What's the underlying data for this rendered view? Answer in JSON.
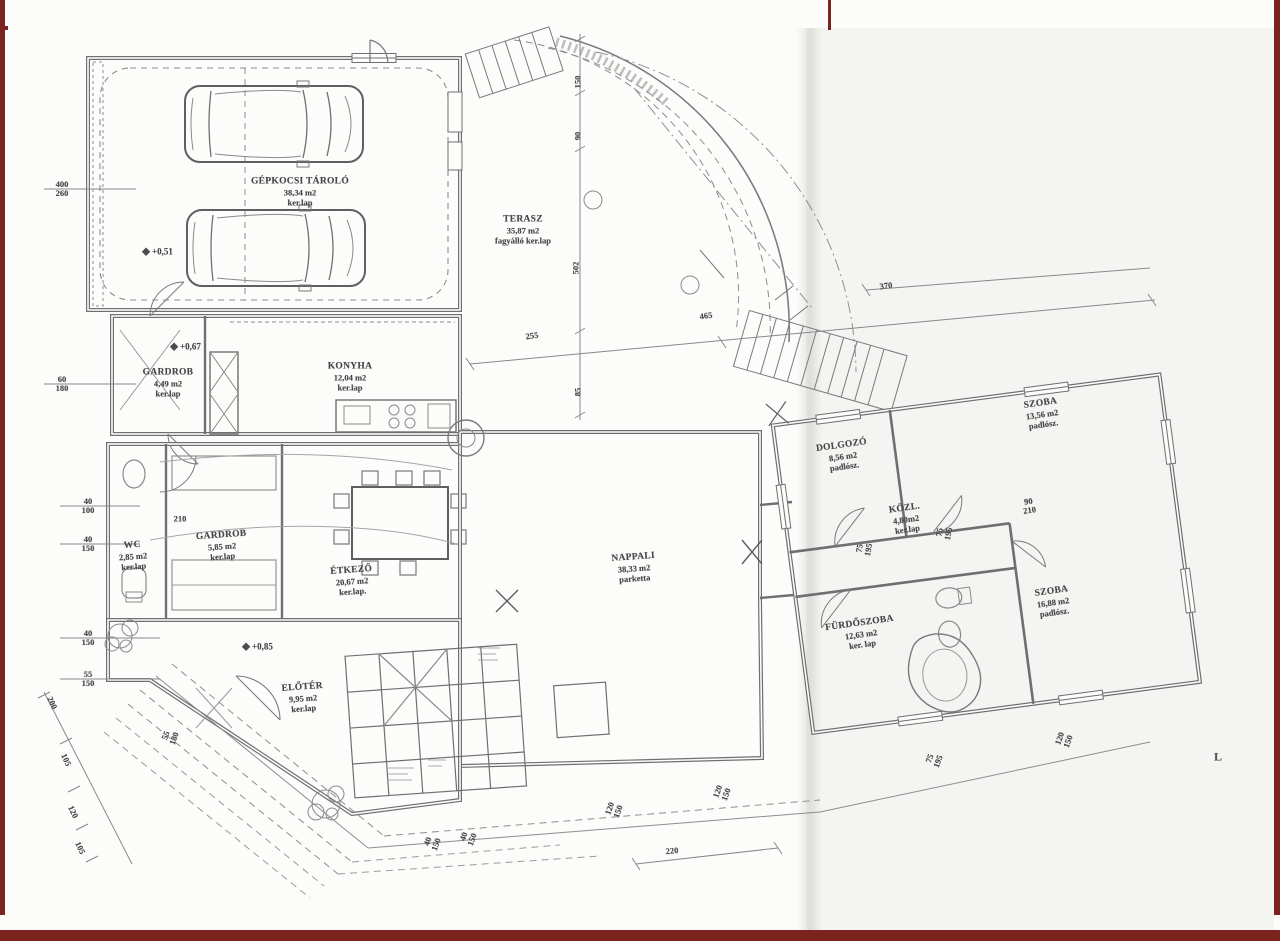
{
  "palette": {
    "frame": "#7c2320",
    "wall": "#6f6f6f",
    "light_line": "#9a9a9a",
    "text": "#474747"
  },
  "plan_title": "Hungarian family house ground-floor plan (scanned blueprint)",
  "rooms": [
    {
      "id": "gepkocsi-tarolo",
      "name": "GÉPKOCSI TÁROLÓ",
      "area": "38,34 m2",
      "floor": "ker.lap",
      "x": 300,
      "y": 192,
      "rot": 0
    },
    {
      "id": "terasz",
      "name": "TERASZ",
      "area": "35,87 m2",
      "floor": "fagyálló ker.lap",
      "x": 523,
      "y": 230,
      "rot": 0
    },
    {
      "id": "konyha",
      "name": "KONYHA",
      "area": "12,04 m2",
      "floor": "ker.lap",
      "x": 350,
      "y": 377,
      "rot": 0
    },
    {
      "id": "gardrob-1",
      "name": "GARDROB",
      "area": "4,49 m2",
      "floor": "ker.lap",
      "x": 168,
      "y": 383,
      "rot": 0
    },
    {
      "id": "wc",
      "name": "WC",
      "area": "2,85 m2",
      "floor": "ker.lap",
      "x": 133,
      "y": 556,
      "rot": -4
    },
    {
      "id": "gardrob-2",
      "name": "GARDROB",
      "area": "5,85 m2",
      "floor": "ker.lap",
      "x": 222,
      "y": 546,
      "rot": -4
    },
    {
      "id": "etkezo",
      "name": "ÉTKEZŐ",
      "area": "20,67 m2",
      "floor": "ker.lap.",
      "x": 352,
      "y": 581,
      "rot": -4
    },
    {
      "id": "nappali",
      "name": "NAPPALI",
      "area": "38,33 m2",
      "floor": "parketta",
      "x": 634,
      "y": 568,
      "rot": -4
    },
    {
      "id": "eloter",
      "name": "ELŐTÉR",
      "area": "9,95 m2",
      "floor": "ker.lap",
      "x": 303,
      "y": 698,
      "rot": -4
    },
    {
      "id": "dolgozo",
      "name": "DOLGOZÓ",
      "area": "8,56 m2",
      "floor": "padlósz.",
      "x": 843,
      "y": 456,
      "rot": -8
    },
    {
      "id": "szoba-1",
      "name": "SZOBA",
      "area": "13,56 m2",
      "floor": "padlósz.",
      "x": 1042,
      "y": 414,
      "rot": -8
    },
    {
      "id": "kozl",
      "name": "KÖZL.",
      "area": "4,80m2",
      "floor": "ker.lap",
      "x": 906,
      "y": 519,
      "rot": -8
    },
    {
      "id": "furdoszoba",
      "name": "FÜRDŐSZOBA",
      "area": "12,63 m2",
      "floor": "ker. lap",
      "x": 861,
      "y": 634,
      "rot": -8
    },
    {
      "id": "szoba-2",
      "name": "SZOBA",
      "area": "16,88 m2",
      "floor": "padlósz.",
      "x": 1053,
      "y": 602,
      "rot": -8
    }
  ],
  "level_markers": [
    {
      "label": "+0,51",
      "x": 158,
      "y": 252
    },
    {
      "label": "+0,67",
      "x": 186,
      "y": 347
    },
    {
      "label": "+0,85",
      "x": 258,
      "y": 647
    }
  ],
  "dimensions": [
    {
      "t": "400",
      "b": "260",
      "x": 62,
      "y": 189,
      "rot": 0
    },
    {
      "t": "60",
      "b": "180",
      "x": 62,
      "y": 384,
      "rot": 0
    },
    {
      "t": "40",
      "b": "100",
      "x": 88,
      "y": 506,
      "rot": 0
    },
    {
      "t": "40",
      "b": "150",
      "x": 88,
      "y": 544,
      "rot": 0
    },
    {
      "t": "40",
      "b": "150",
      "x": 88,
      "y": 638,
      "rot": 0
    },
    {
      "t": "55",
      "b": "150",
      "x": 88,
      "y": 679,
      "rot": 0
    },
    {
      "t": "150",
      "x": 578,
      "y": 82,
      "rot": -90
    },
    {
      "t": "90",
      "x": 578,
      "y": 136,
      "rot": -90
    },
    {
      "t": "502",
      "x": 576,
      "y": 268,
      "rot": -90
    },
    {
      "t": "85",
      "x": 578,
      "y": 392,
      "rot": -90
    },
    {
      "t": "255",
      "x": 532,
      "y": 336,
      "rot": -8
    },
    {
      "t": "465",
      "x": 706,
      "y": 316,
      "rot": -8
    },
    {
      "t": "370",
      "x": 886,
      "y": 286,
      "rot": -8
    },
    {
      "t": "210",
      "x": 180,
      "y": 519,
      "rot": 0
    },
    {
      "t": "90",
      "b": "210",
      "x": 1029,
      "y": 506,
      "rot": -8
    },
    {
      "t": "75",
      "b": "195",
      "x": 864,
      "y": 549,
      "rot": -80
    },
    {
      "t": "75",
      "b": "195",
      "x": 944,
      "y": 533,
      "rot": -80
    },
    {
      "t": "120",
      "b": "150",
      "x": 614,
      "y": 810,
      "rot": -70
    },
    {
      "t": "120",
      "b": "150",
      "x": 722,
      "y": 793,
      "rot": -70
    },
    {
      "t": "75",
      "b": "195",
      "x": 934,
      "y": 760,
      "rot": -70
    },
    {
      "t": "120",
      "b": "150",
      "x": 1064,
      "y": 740,
      "rot": -70
    },
    {
      "t": "55",
      "b": "180",
      "x": 170,
      "y": 737,
      "rot": -70
    },
    {
      "t": "40",
      "b": "150",
      "x": 432,
      "y": 843,
      "rot": -70
    },
    {
      "t": "40",
      "b": "150",
      "x": 468,
      "y": 838,
      "rot": -70
    },
    {
      "t": "220",
      "x": 672,
      "y": 851,
      "rot": -5
    },
    {
      "t": "200",
      "x": 52,
      "y": 703,
      "rot": 65
    },
    {
      "t": "105",
      "x": 66,
      "y": 760,
      "rot": 65
    },
    {
      "t": "120",
      "x": 73,
      "y": 812,
      "rot": 65
    },
    {
      "t": "105",
      "x": 80,
      "y": 848,
      "rot": 65
    },
    {
      "t": "L",
      "x": 1218,
      "y": 757,
      "rot": 0,
      "cls": "lmark"
    }
  ]
}
